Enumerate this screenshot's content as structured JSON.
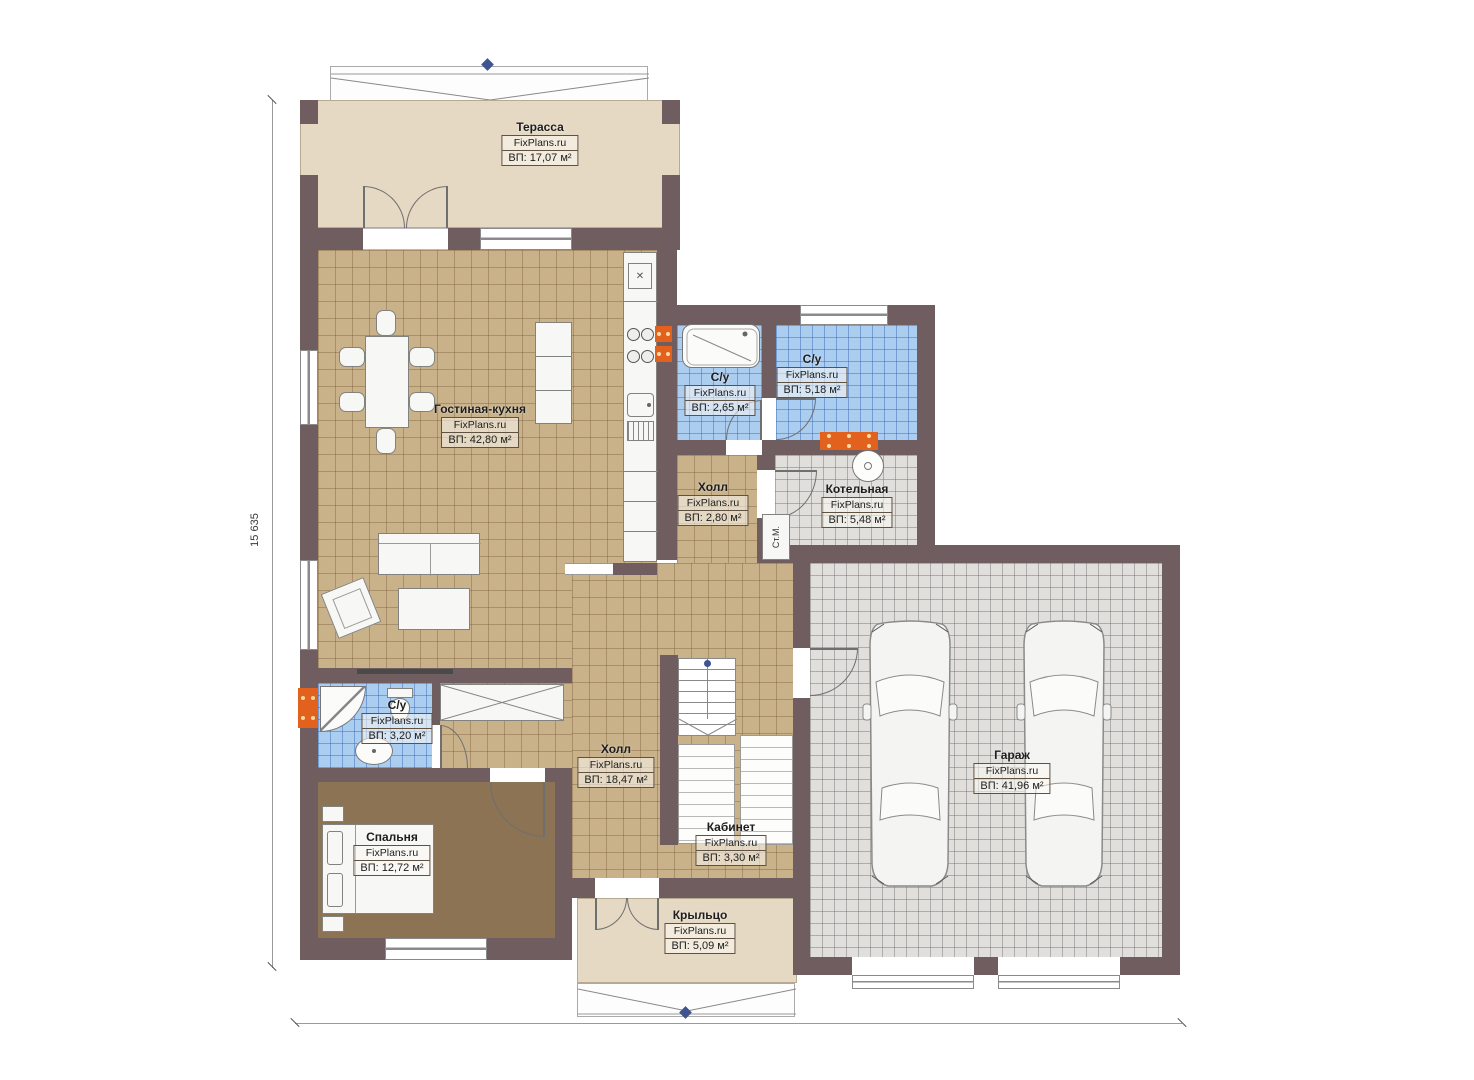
{
  "brand": "FixPlans.ru",
  "rooms": {
    "terrace": {
      "name": "Терасса",
      "area": "ВП: 17,07 м²"
    },
    "living_kitchen": {
      "name": "Гостиная-кухня",
      "area": "ВП: 42,80 м²"
    },
    "wc_top": {
      "name": "С/у",
      "area": "ВП: 2,65 м²"
    },
    "wc_right": {
      "name": "С/у",
      "area": "ВП: 5,18 м²"
    },
    "hall_small": {
      "name": "Холл",
      "area": "ВП: 2,80 м²"
    },
    "boiler": {
      "name": "Котельная",
      "area": "ВП: 5,48 м²"
    },
    "wc_bottom": {
      "name": "С/у",
      "area": "ВП: 3,20 м²"
    },
    "hall_main": {
      "name": "Холл",
      "area": "ВП: 18,47 м²"
    },
    "cabinet": {
      "name": "Кабинет",
      "area": "ВП: 3,30 м²"
    },
    "bedroom": {
      "name": "Спальня",
      "area": "ВП: 12,72 м²"
    },
    "porch": {
      "name": "Крыльцо",
      "area": "ВП: 5,09 м²"
    },
    "garage": {
      "name": "Гараж",
      "area": "ВП: 41,96 м²"
    }
  },
  "fixtures": {
    "washing_machine": "Ст.М.",
    "vent_glyph": "✕"
  },
  "dimensions": {
    "left_total": "15 635",
    "bottom_total": "15 790"
  },
  "colors": {
    "wall": "#6f5d5f",
    "floor_tan": "#c9b189",
    "floor_blue": "#abcdf0",
    "floor_gray": "#e0dfdc",
    "floor_beige": "#e6d9c3",
    "floor_wood": "#8b7353",
    "accent_orange": "#e2611c",
    "marker_blue": "#3f5490"
  }
}
